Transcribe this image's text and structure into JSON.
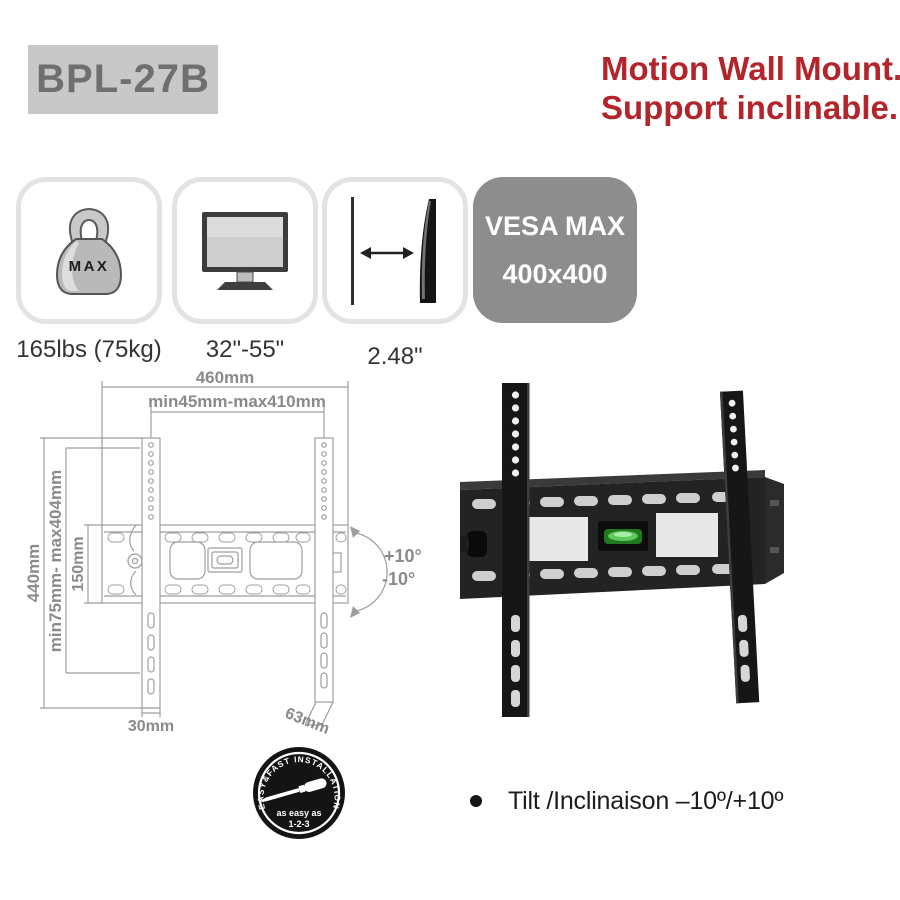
{
  "header": {
    "model": "BPL-27B",
    "title_line1": "Motion Wall Mount.",
    "title_line2": "Support inclinable."
  },
  "features": {
    "weight": {
      "icon": "max-weight-icon",
      "badge_text": "MAX",
      "label": "165lbs (75kg)"
    },
    "screen": {
      "icon": "screen-size-icon",
      "label": "32\"-55\""
    },
    "depth": {
      "icon": "slim-profile-icon",
      "label": "2.48\""
    }
  },
  "vesa": {
    "line1": "VESA MAX",
    "line2": "400x400"
  },
  "diagram": {
    "width_total": "460mm",
    "width_range": "min45mm-max410mm",
    "height_total": "440mm",
    "height_range": "min75mm- max404mm",
    "plate_height": "150mm",
    "rail_width": "30mm",
    "depth": "63mm",
    "tilt_up": "+10°",
    "tilt_down": "-10°"
  },
  "badge": {
    "arc_text": "EASY&FAST INSTALLATION",
    "line1": "as easy as",
    "line2": "1-2-3"
  },
  "bullet": {
    "text": "Tilt /Inclinaison –10º/+10º"
  },
  "colors": {
    "accent_red": "#b3242b",
    "model_box_bg": "#c8c8c8",
    "model_text": "#6f6f6f",
    "vesa_bg": "#8d8d8d",
    "feature_border": "#e3e3e3",
    "diagram_line": "#9e9e9e",
    "diagram_label": "#8a8a8a",
    "mount_black": "#1a1a1a",
    "level_green": "#3fae3f"
  }
}
